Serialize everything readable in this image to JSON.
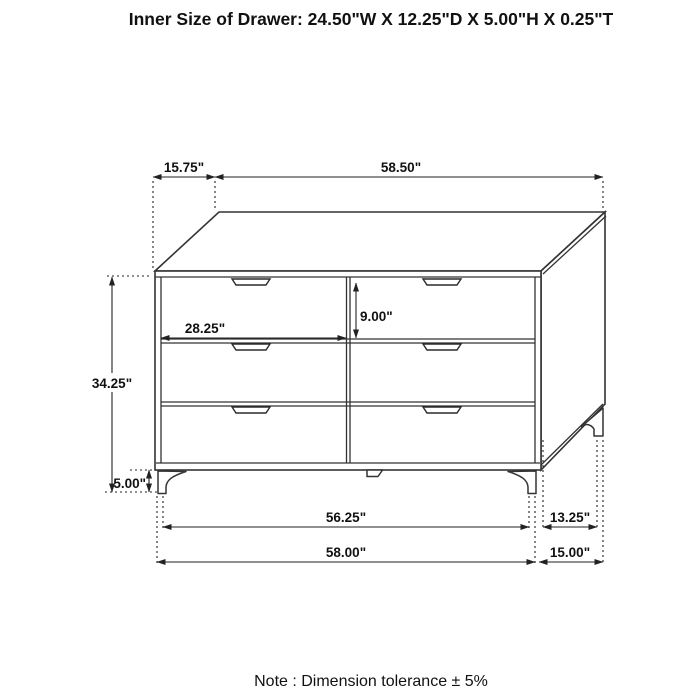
{
  "title": "Inner Size of Drawer: 24.50\"W X 12.25\"D X 5.00\"H X 0.25\"T",
  "note": "Note : Dimension tolerance  ± 5%",
  "dimensions": {
    "top_offset_depth": "15.75\"",
    "top_width": "58.50\"",
    "drawer_front_width": "28.25\"",
    "drawer_front_height": "9.00\"",
    "body_height": "34.25\"",
    "leg_height": "5.00\"",
    "front_leg_span": "56.25\"",
    "side_leg_span": "13.25\"",
    "overall_width": "58.00\"",
    "overall_depth": "15.00\""
  },
  "colors": {
    "line": "#333333",
    "dimension_line": "#222222",
    "text": "#111111",
    "background": "#ffffff"
  }
}
